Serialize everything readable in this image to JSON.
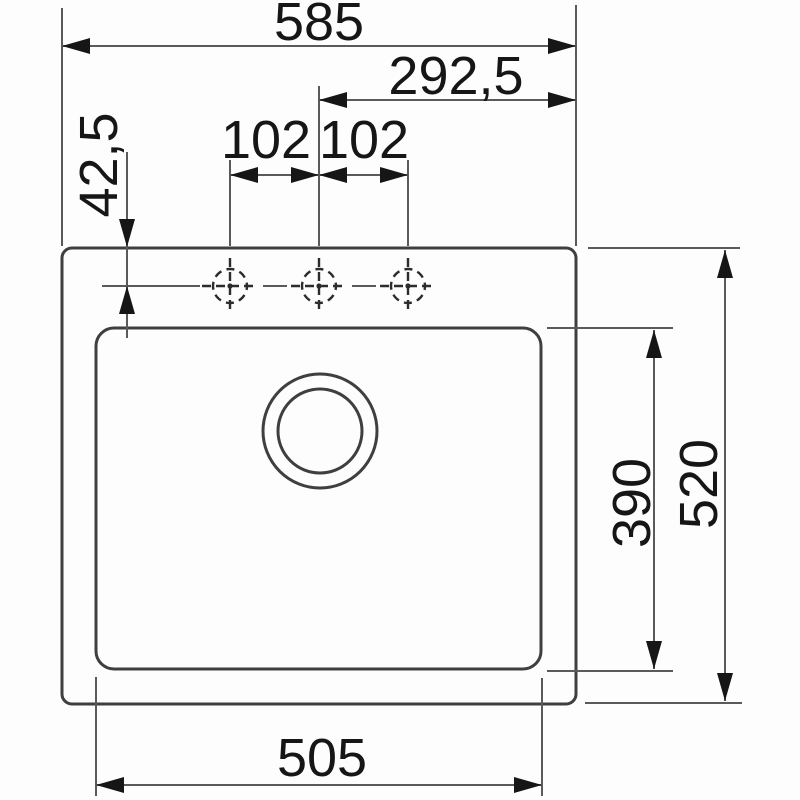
{
  "colors": {
    "background": "#fdfdfd",
    "outline": "#3f3f3f",
    "dimension_line": "#5a5a5a",
    "annotation": "#161616",
    "crosshair": "#2c2c2c"
  },
  "dims": {
    "top_width": "585",
    "center_offset": "292,5",
    "hole_spacing_left": "102",
    "hole_spacing_right": "102",
    "hole_edge_offset": "42,5",
    "bowl_depth": "390",
    "overall_depth": "520",
    "bowl_width": "505"
  }
}
